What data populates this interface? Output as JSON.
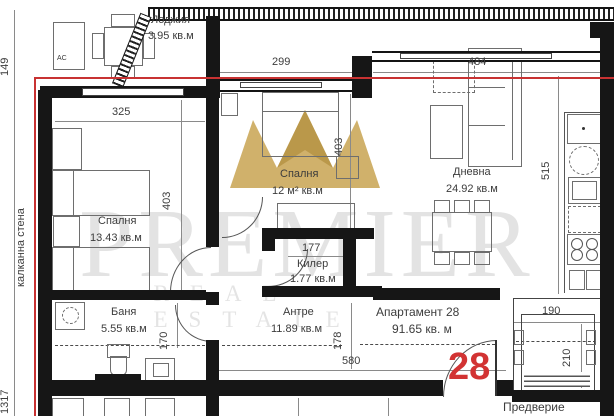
{
  "watermark": {
    "brand": "PREMIER",
    "tagline": "REAL ESTATE"
  },
  "labels": {
    "party_wall": "калканна стена",
    "vestibule": "Предверие",
    "ac": "AC",
    "apartment_title": "Апартамент 28",
    "apartment_area": "91.65 кв. м",
    "apartment_number": "28"
  },
  "rooms": {
    "loggia": {
      "name": "Лоджия",
      "area": "3.95 кв.м"
    },
    "bedroom1": {
      "name": "Спалня",
      "area": "13.43 кв.м"
    },
    "bedroom2": {
      "name": "Спалня",
      "area": "12 м² кв.м"
    },
    "living": {
      "name": "Дневна",
      "area": "24.92 кв.м"
    },
    "storage": {
      "name": "Килер",
      "area": "1.77 кв.м"
    },
    "bath": {
      "name": "Баня",
      "area": "5.55 кв.м"
    },
    "hall": {
      "name": "Антре",
      "area": "11.89 кв.м"
    }
  },
  "dimensions": {
    "h149": "149",
    "v1317": "1317",
    "w325": "325",
    "h403a": "403",
    "w299": "299",
    "h403b": "403",
    "w484": "484",
    "h515": "515",
    "w177": "177",
    "h170": "170",
    "h178": "178",
    "w580": "580",
    "w190": "190",
    "h210": "210"
  }
}
